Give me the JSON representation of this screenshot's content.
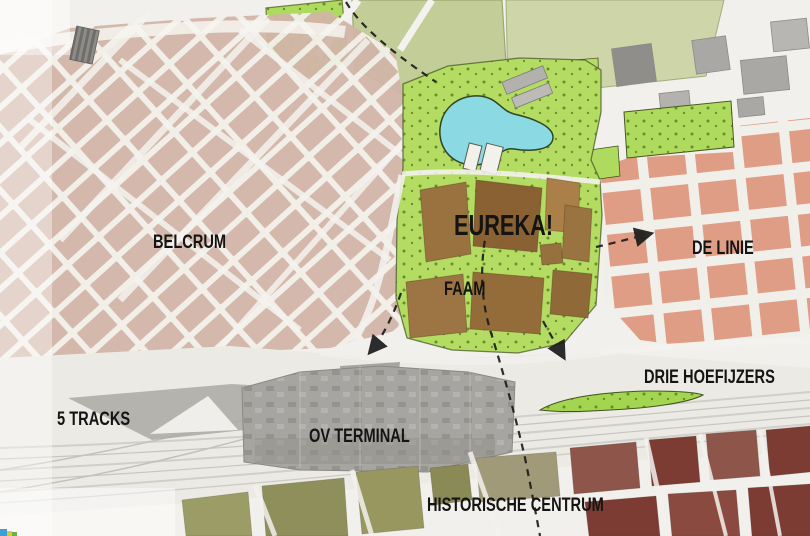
{
  "map": {
    "labels": {
      "belcrum": "BELCRUM",
      "eureka": "EUREKA!",
      "faam": "FAAM",
      "de_linie": "DE LINIE",
      "drie_hoefijzers": "DRIE HOEFIJZERS",
      "five_tracks": "5 TRACKS",
      "ov_terminal": "OV TERMINAL",
      "historische_centrum": "HISTORISCHE CENTRUM"
    },
    "colors": {
      "background": "#f2f0ec",
      "belcrum_block": "#c9a697",
      "de_linie_block": "#dd8e74",
      "eureka_block_dark": "#8a6133",
      "eureka_block_mid": "#9a7240",
      "eureka_block_light": "#aa8048",
      "park_green": "#b5dc62",
      "strip_green": "#a8d957",
      "field_olive": "#c2cd97",
      "pond_blue": "#8bd9e2",
      "terminal_grey": "#a6a5a1",
      "rail_grey": "#eceae5",
      "centrum_olive": "#9c9c66",
      "centrum_red": "#7c3c33",
      "route_black": "#1c1c1c"
    }
  }
}
